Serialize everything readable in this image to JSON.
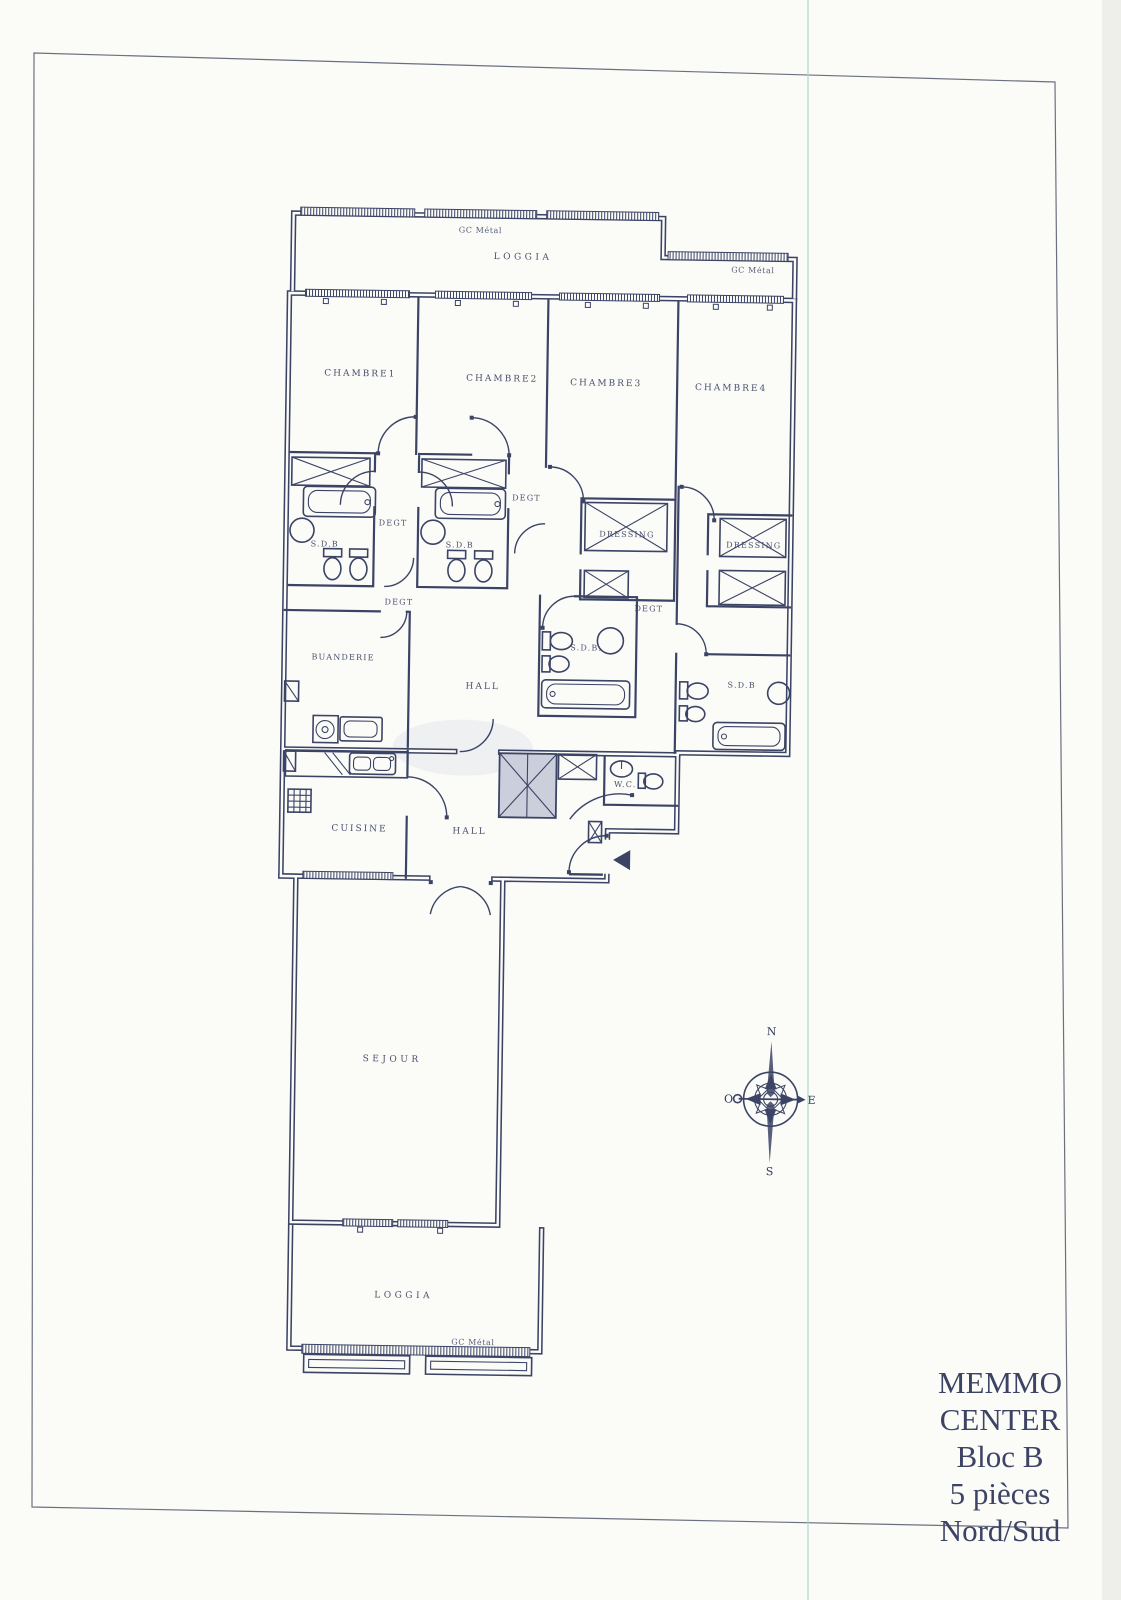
{
  "plan": {
    "title_block": {
      "line1": "MEMMO",
      "line2": "CENTER",
      "line3": "Bloc B",
      "line4": "5 pièces",
      "line5": "Nord/Sud"
    },
    "rooms": {
      "loggia_top": "LOGGIA",
      "loggia_bottom": "LOGGIA",
      "chambre1": "CHAMBRE1",
      "chambre2": "CHAMBRE2",
      "chambre3": "CHAMBRE3",
      "chambre4": "CHAMBRE4",
      "sdb1": "S.D.B",
      "sdb2": "S.D.B",
      "sdb3": "S.D.B.",
      "sdb4": "S.D.B",
      "degt1": "DEGT",
      "degt2": "DEGT",
      "degt3": "DEGT",
      "degt4": "DEGT",
      "dressing1": "DRESSING",
      "dressing2": "DRESSING",
      "buanderie": "BUANDERIE",
      "hall_upper": "HALL",
      "hall_lower": "HALL",
      "cuisine": "CUISINE",
      "wc": "W.C.",
      "sejour": "SEJOUR"
    },
    "annotations": {
      "gc_metal_top": "GC Métal",
      "gc_metal_right": "GC Métal",
      "gc_metal_bottom": "GC Métal"
    },
    "compass": {
      "north": "N",
      "east": "E",
      "south": "S",
      "west": "O"
    },
    "colors": {
      "ink": "#3c4466",
      "paper": "#fbfbf8",
      "scan_line": "#a6d6cf"
    }
  }
}
